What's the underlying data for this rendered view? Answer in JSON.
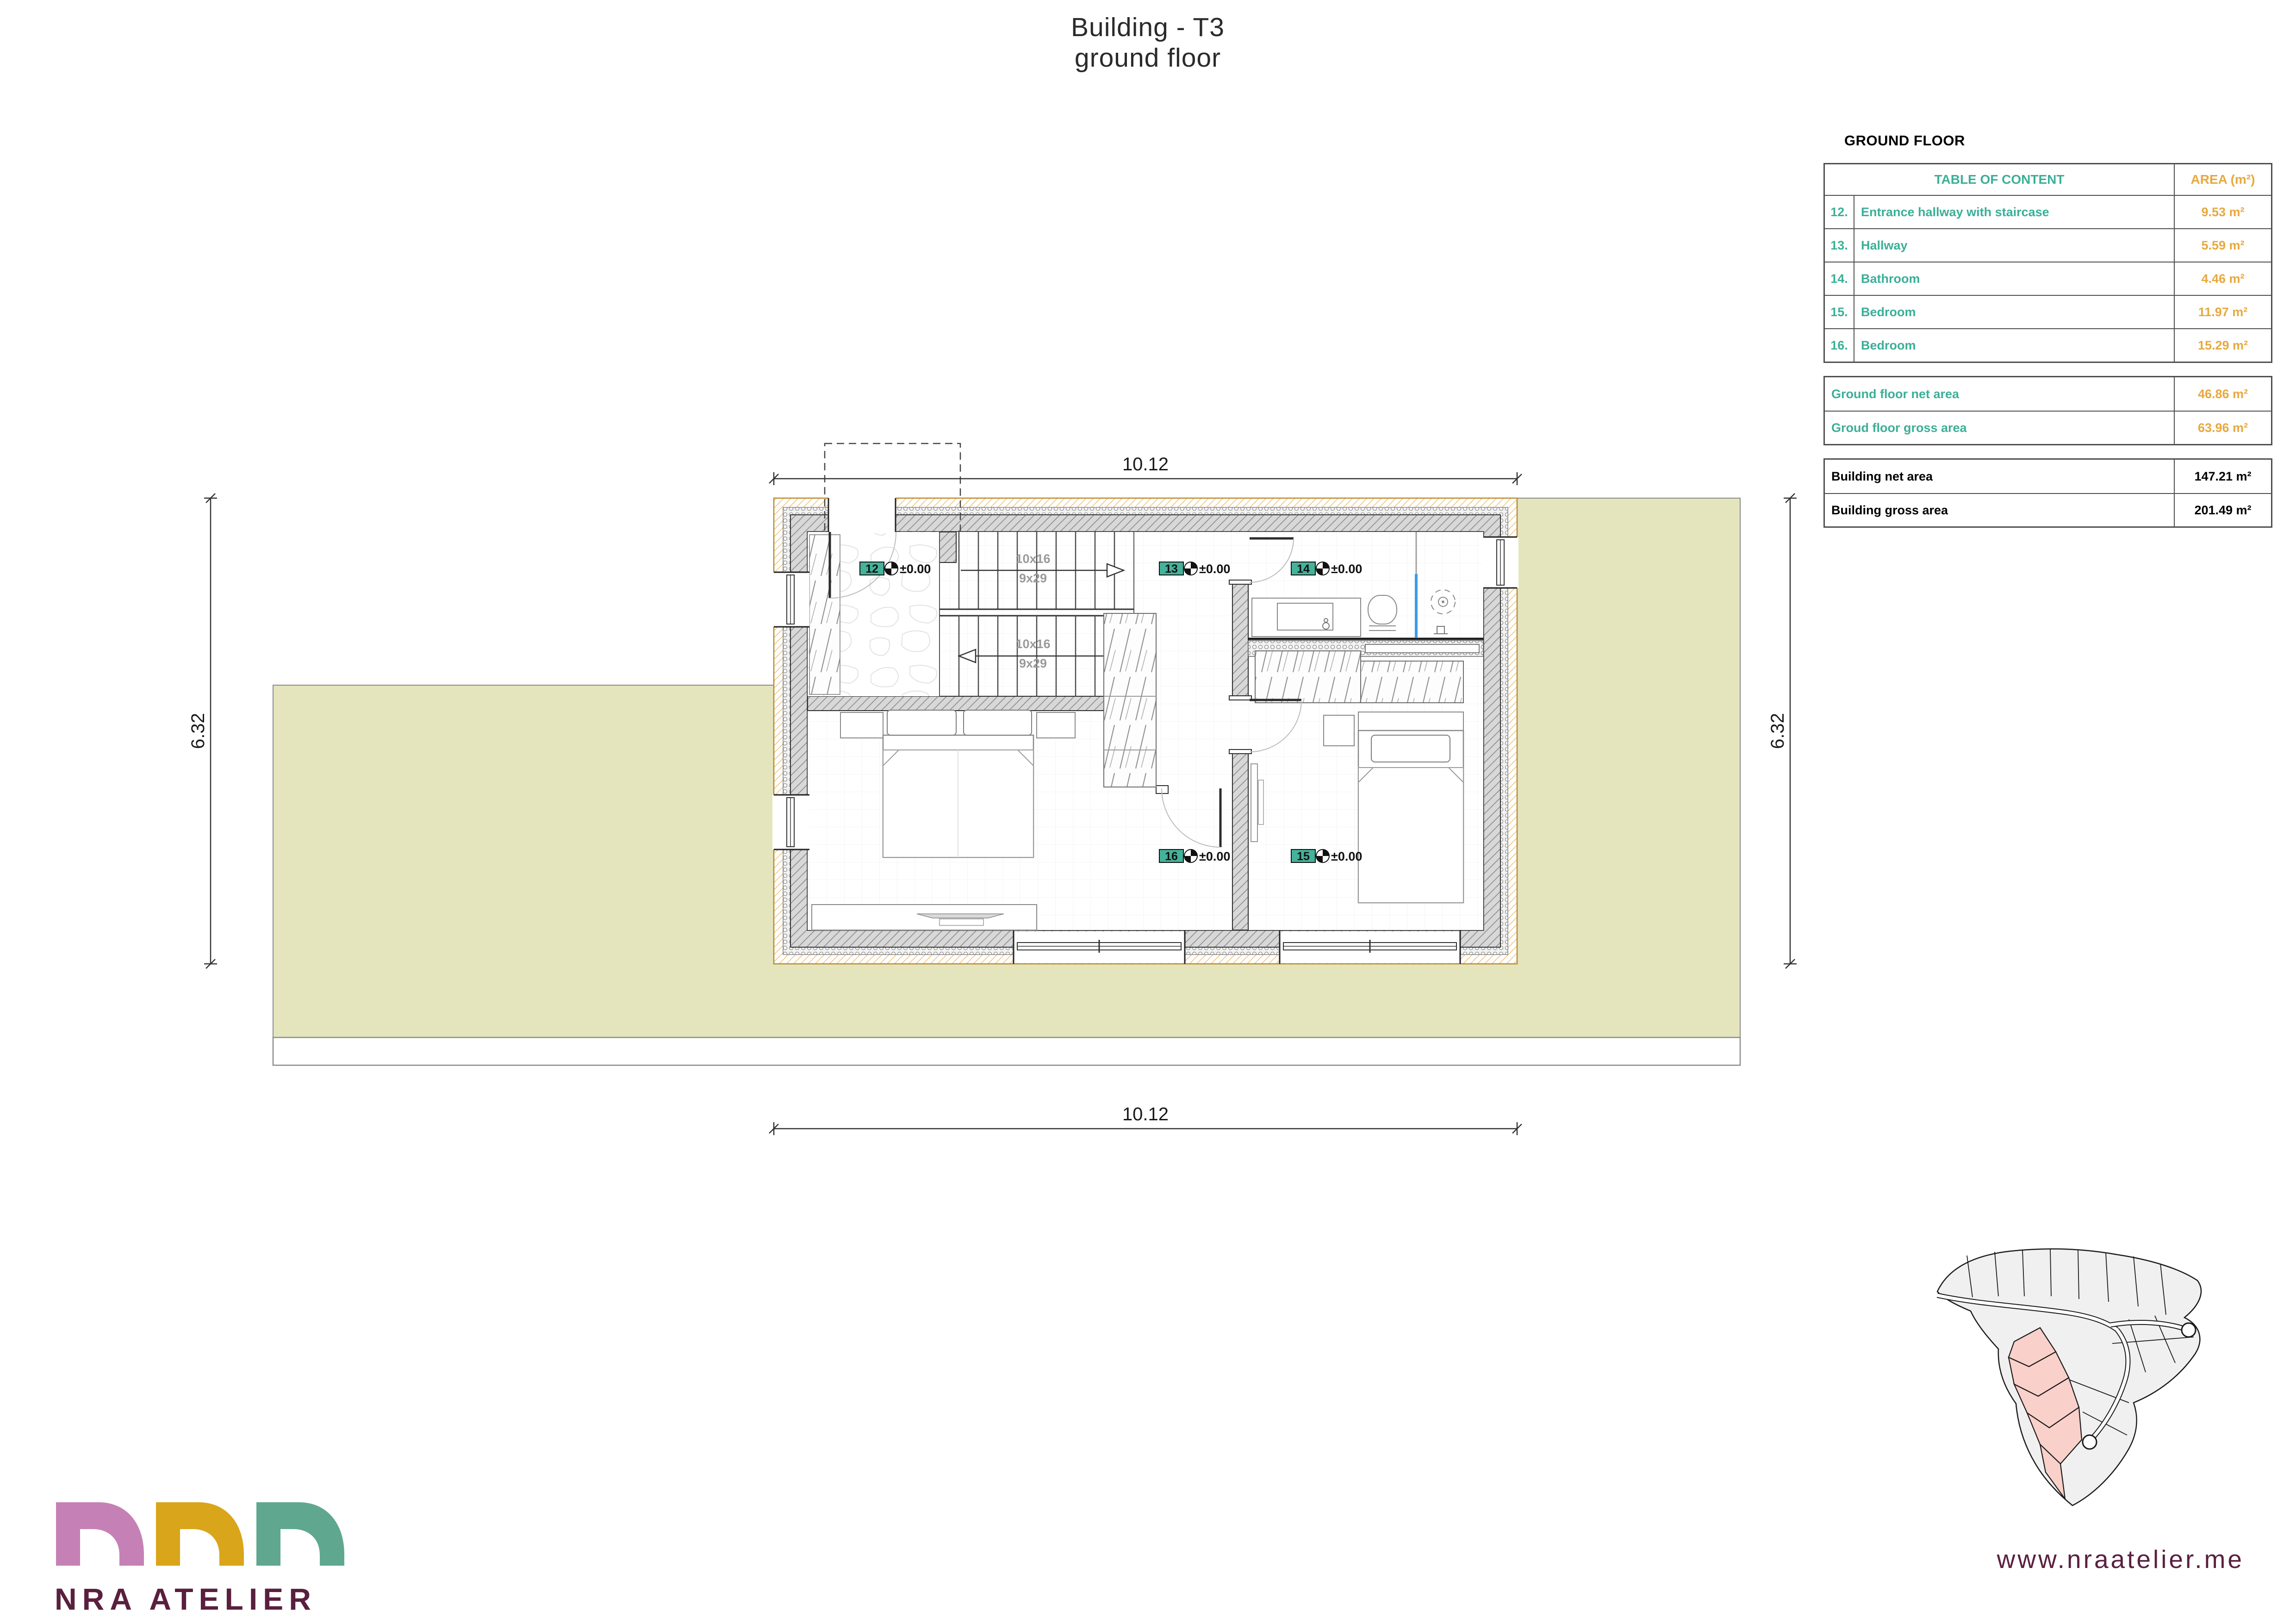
{
  "title": {
    "line1": "Building - T3",
    "line2": "ground floor"
  },
  "ground_floor_table": {
    "heading": "GROUND FLOOR",
    "content_header": "TABLE OF CONTENT",
    "area_header": "AREA (m²)",
    "rows": [
      {
        "num": "12.",
        "name": "Entrance hallway with staircase",
        "area": "9.53 m²"
      },
      {
        "num": "13.",
        "name": "Hallway",
        "area": "5.59 m²"
      },
      {
        "num": "14.",
        "name": "Bathroom",
        "area": "4.46 m²"
      },
      {
        "num": "15.",
        "name": "Bedroom",
        "area": "11.97 m²"
      },
      {
        "num": "16.",
        "name": "Bedroom",
        "area": "15.29 m²"
      }
    ],
    "floor_summary": [
      {
        "label": "Ground floor net area",
        "area": "46.86 m²"
      },
      {
        "label": "Groud floor gross area",
        "area": "63.96 m²"
      }
    ],
    "building_summary": [
      {
        "label": "Building net area",
        "area": "147.21 m²"
      },
      {
        "label": "Building gross area",
        "area": "201.49 m²"
      }
    ]
  },
  "plan": {
    "dim_top": "10.12",
    "dim_bottom": "10.12",
    "dim_left": "6.32",
    "dim_right": "6.32",
    "stair_flight1": {
      "line1": "10x16",
      "line2": "9x29"
    },
    "stair_flight2": {
      "line1": "10x16",
      "line2": "9x29"
    },
    "room_tags": [
      {
        "num": "12",
        "level": "±0.00"
      },
      {
        "num": "13",
        "level": "±0.00"
      },
      {
        "num": "14",
        "level": "±0.00"
      },
      {
        "num": "15",
        "level": "±0.00"
      },
      {
        "num": "16",
        "level": "±0.00"
      }
    ]
  },
  "branding": {
    "logo_text": "NRA ATELIER",
    "website": "www.nraatelier.me"
  },
  "colors": {
    "teal_text": "#3BAF97",
    "orange_text": "#E8A83E",
    "plum": "#5A1F3E",
    "site_beige": "#E4E5BD",
    "parcel_pink": "#FAD0CA",
    "tag_teal": "#45B29A",
    "shower_glass_blue": "#3D9BE9",
    "insulation_orange": "#EAAA45"
  }
}
